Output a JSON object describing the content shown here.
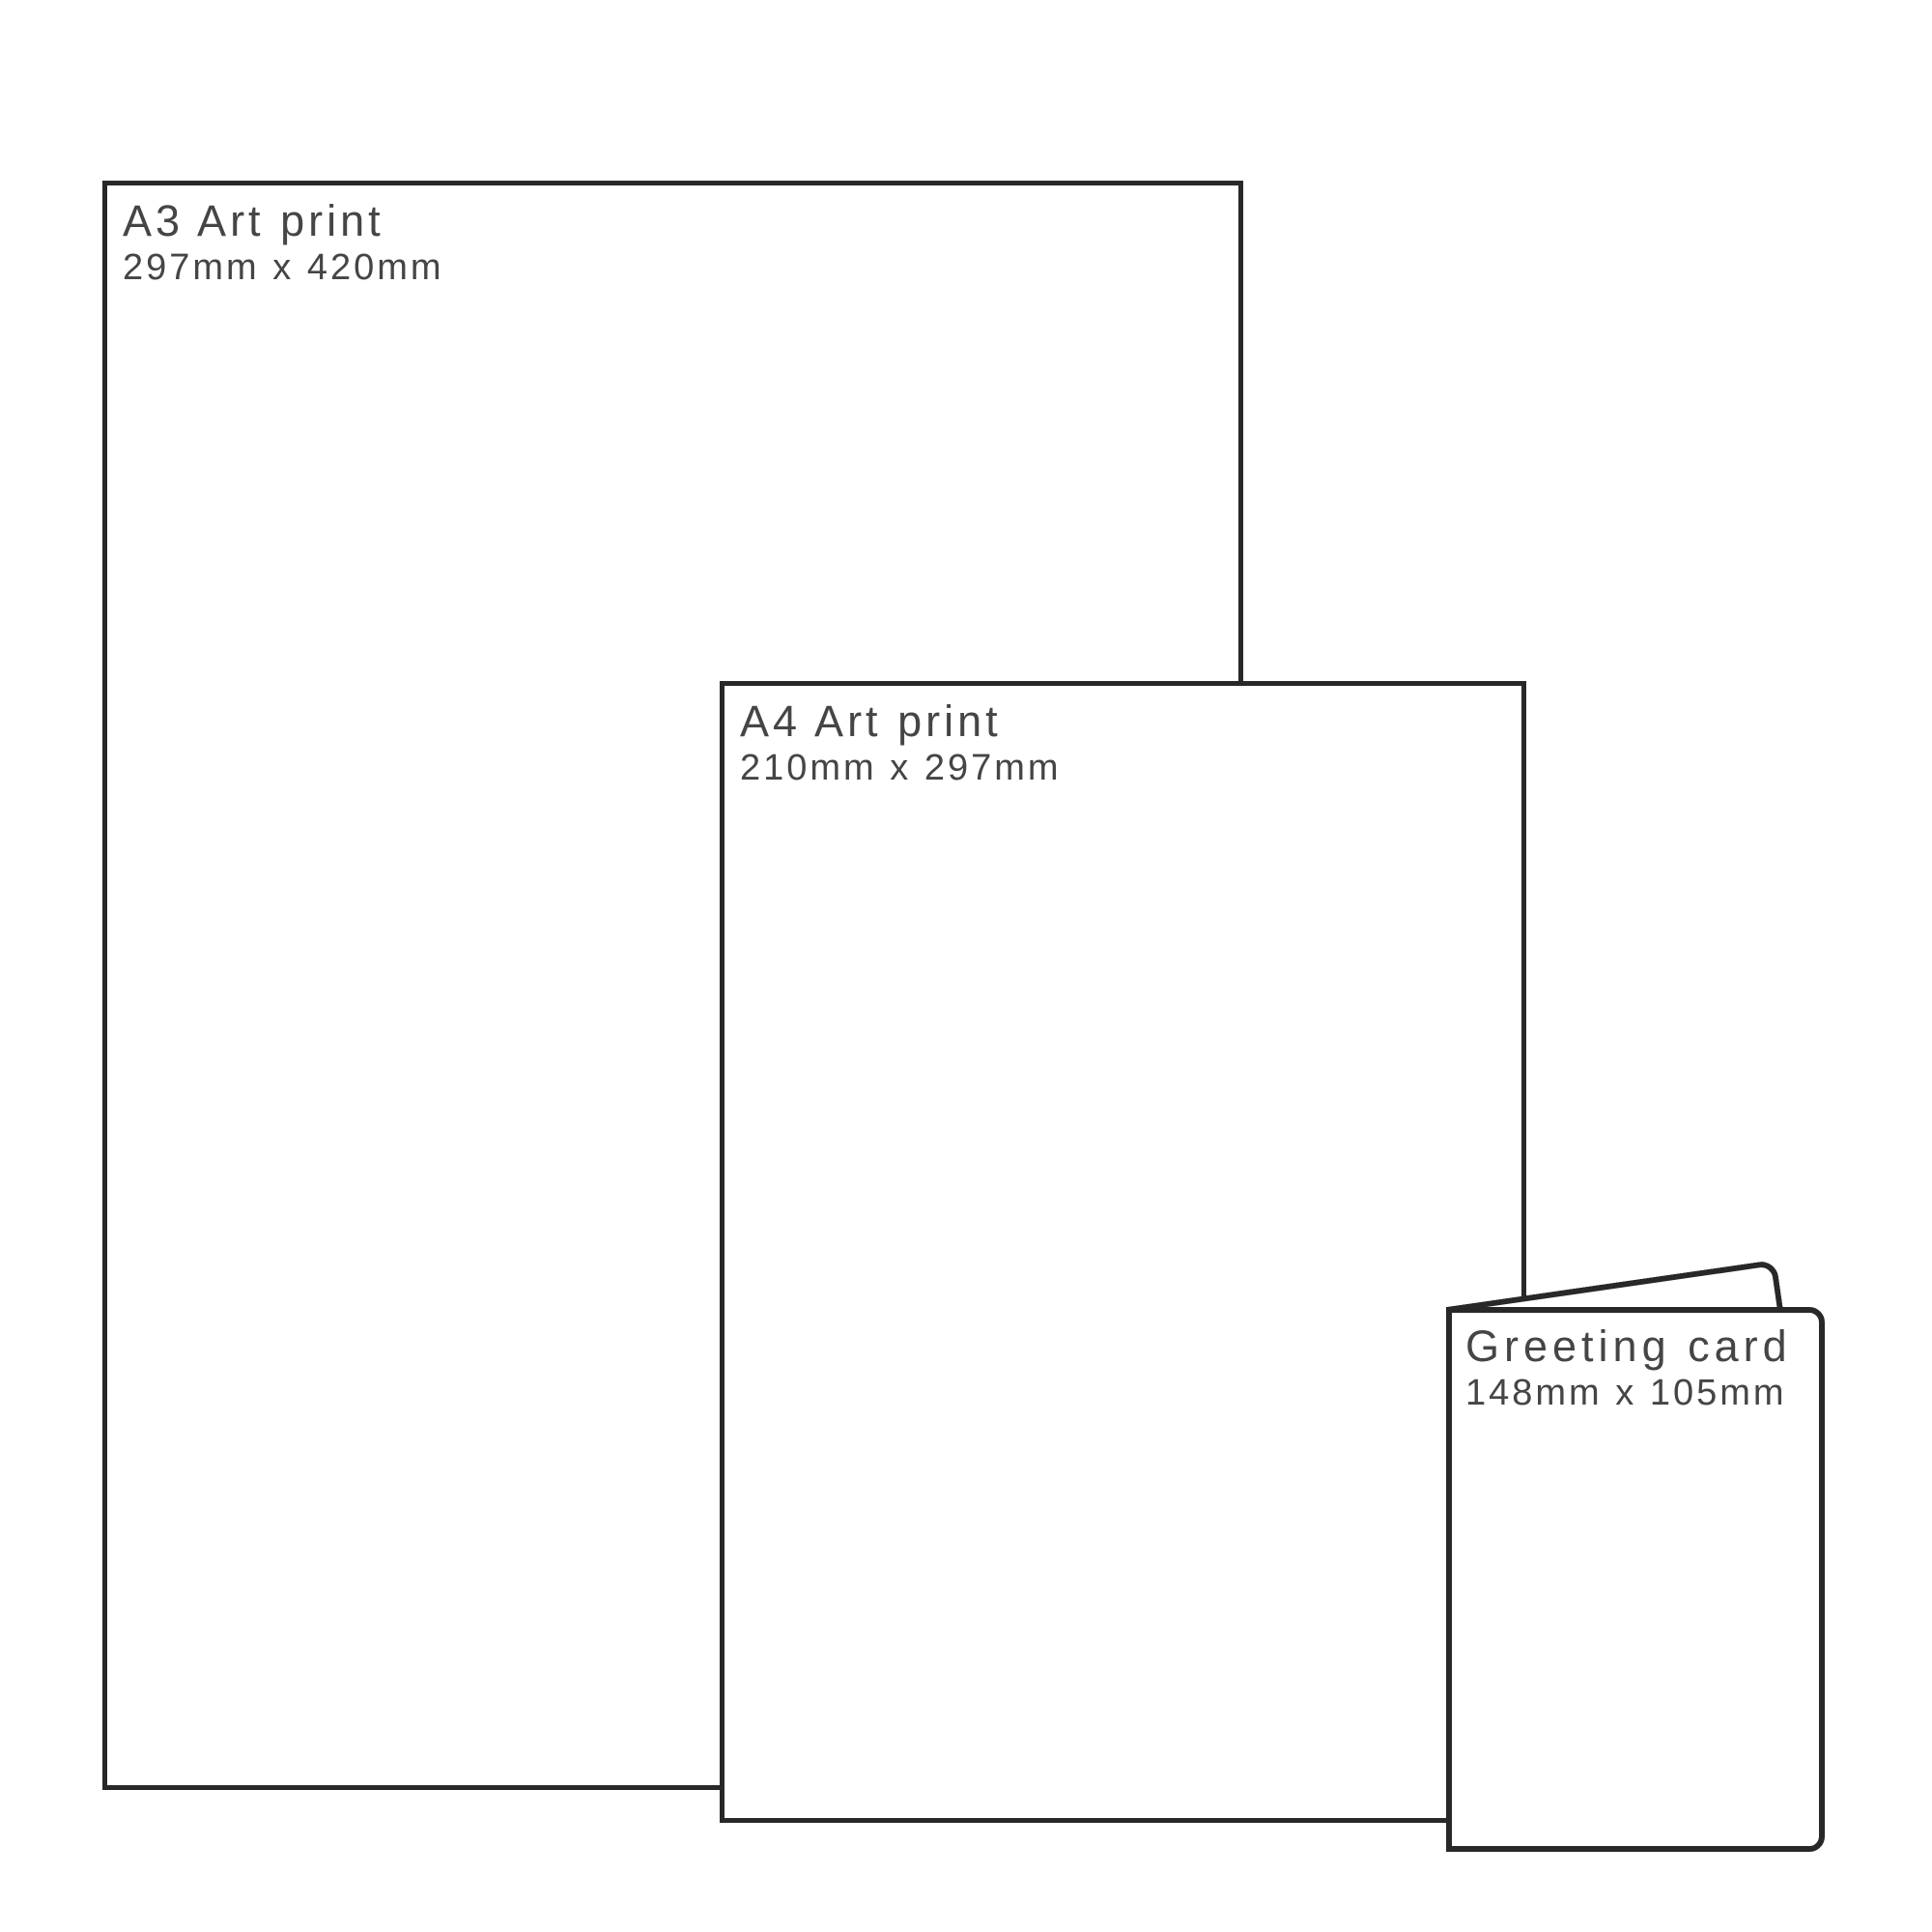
{
  "diagram": {
    "background": "#ffffff",
    "stroke_color": "#282828",
    "text_color": "#454545",
    "items": [
      {
        "name": "A3 Art print",
        "size": "297mm x 420mm"
      },
      {
        "name": "A4 Art print",
        "size": "210mm x 297mm"
      },
      {
        "name": "Greeting card",
        "size": "148mm x 105mm"
      }
    ]
  }
}
